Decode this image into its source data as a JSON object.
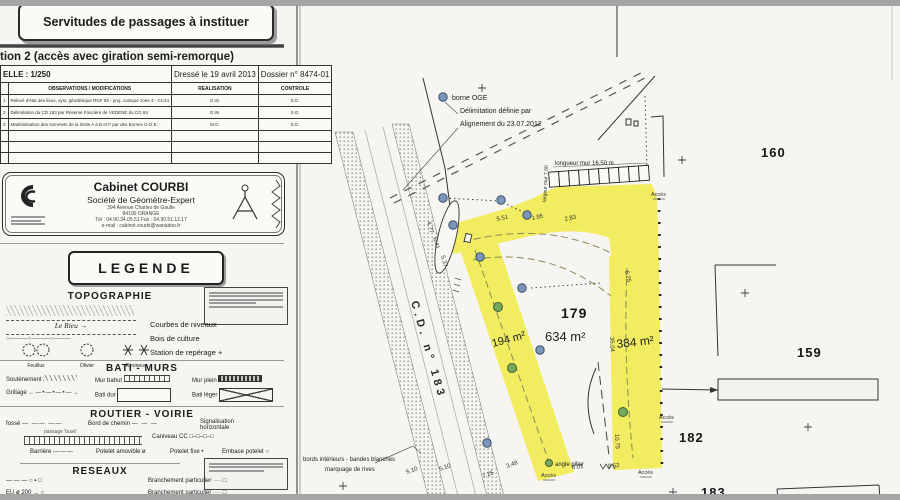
{
  "panel": {
    "box_title": "Servitudes de passages à instituer",
    "subtitle": "tion 2 (accès avec giration semi-remorque)",
    "table": {
      "scale": "ELLE : 1/250",
      "date": "Dressé le 19 avril 2013",
      "dossier": "Dossier n° 8474-01",
      "col_obs": "OBSERVATIONS / MODIFICATIONS",
      "col_real": "REALISATION",
      "col_ctrl": "CONTROLE",
      "rows": [
        {
          "n": "1",
          "obs": "Relevé d'état des lieux, syst. géodésique RGF 93 - proj. conique zone 3 - CC44",
          "real": "G.W.",
          "ctrl": "S.G."
        },
        {
          "n": "2",
          "obs": "Délimitation du CD 183 par Réserve Foncière de VEDENE du CG 84",
          "real": "G.W.",
          "ctrl": "S.G."
        },
        {
          "n": "3",
          "obs": "Matérialisation des sommets de la limite A à B et F par des Bornes O.G.E.",
          "real": "M.G.",
          "ctrl": "S.G."
        }
      ]
    },
    "firm": {
      "name": "Cabinet COURBI",
      "subtitle": "Société de Géomètre-Expert",
      "addr1": "394 Avenue Charles de Gaulle",
      "addr2": "84100 ORANGE",
      "addr3": "Tél : 04.90.34.05.51   Fax : 04.90.51.12.17",
      "addr4": "e-mail : cabinet.courbi@wanadoo.fr"
    },
    "legend": {
      "title": "LEGENDE",
      "topo": {
        "title": "TOPOGRAPHIE",
        "stream": "Le Rieu →",
        "fence": "○———○———○———",
        "c1": "Courbes de niveaux",
        "c2": "Bois de culture",
        "c3": "Station de repérage +",
        "t1": "Feuillus",
        "t2": "Olivier",
        "t3": "Résineux"
      },
      "bati": {
        "title": "BATI - MURS",
        "i1": "Soutènement",
        "i2": "Mur bahut",
        "i3": "Mur plein",
        "i4": "Grillage",
        "i4g": "←—•—•—•—→",
        "i5": "Bati dur",
        "i6": "Bati léger"
      },
      "routier": {
        "title": "ROUTIER - VOIRIE",
        "r1a": "fossé",
        "r1ag": "— —— ——",
        "r1b": "Bord de chemin",
        "r1bg": "— — —",
        "r1c": "Signalisation",
        "r1c2": "horizontale",
        "r2a": "passage 'busé'",
        "r2b": "Caniveau CC",
        "r2bg": "□–□–□–□",
        "r3a": "Barrière",
        "r3ag": "———",
        "r3b": "Potelet amovible ø",
        "r3c": "Potelet fixe •",
        "r3d": "Embase potelet ○"
      },
      "reseaux": {
        "title": "RESEAUX",
        "r1g": "— — —   ○ ▪ □",
        "r1b": "Branchement particulier ···· □",
        "r2g": "EU ø 200 →   ○",
        "r2b": "Branchement particulier ···· □"
      }
    }
  },
  "map": {
    "road_label": "C.D.   n° 183",
    "access_label": "Accès",
    "colors": {
      "highlight": "#f2ec60",
      "borne": "#7b96b8",
      "tree": "#74a85c"
    },
    "wall": {
      "count": 10,
      "x": 254,
      "y": 169,
      "w": 10,
      "h": 15,
      "rot": -4
    },
    "parcels": [
      {
        "t": "179",
        "x": 266,
        "y": 318,
        "s": 14
      },
      {
        "t": "160",
        "x": 466,
        "y": 157,
        "s": 13
      },
      {
        "t": "159",
        "x": 502,
        "y": 357,
        "s": 13
      },
      {
        "t": "182",
        "x": 384,
        "y": 442,
        "s": 13
      },
      {
        "t": "183",
        "x": 406,
        "y": 497,
        "s": 13
      }
    ],
    "areas": [
      {
        "t": "634 m²",
        "x": 250,
        "y": 341,
        "s": 13,
        "r": 0
      },
      {
        "t": "194 m²",
        "x": 198,
        "y": 347,
        "s": 11,
        "r": -15
      },
      {
        "t": "384 m²",
        "x": 322,
        "y": 348,
        "s": 12,
        "r": -6
      }
    ],
    "annotations": [
      {
        "t": "borne OGE",
        "x": 157,
        "y": 100,
        "s": 7
      },
      {
        "t": "Délimitation définie par",
        "x": 165,
        "y": 113,
        "s": 7
      },
      {
        "t": "Alignement du 23.07.2012",
        "x": 165,
        "y": 126,
        "s": 7
      },
      {
        "t": "longueur mur  16.50 m",
        "x": 260,
        "y": 165,
        "s": 6
      },
      {
        "t": "largeur mur 7.60",
        "x": 251,
        "y": 202,
        "s": 5,
        "r": -87
      },
      {
        "t": "bords intérieurs - bandes blanches",
        "x": 8,
        "y": 461,
        "s": 6
      },
      {
        "t": "marquage de rives",
        "x": 30,
        "y": 471,
        "s": 6
      },
      {
        "t": "angle pilier",
        "x": 260,
        "y": 466,
        "s": 6
      }
    ],
    "dimensions": [
      {
        "t": "4.77",
        "x": 132,
        "y": 222,
        "r": 75
      },
      {
        "t": "6.41",
        "x": 138,
        "y": 238,
        "r": 75
      },
      {
        "t": "5.37",
        "x": 146,
        "y": 256,
        "r": 75
      },
      {
        "t": "5.51",
        "x": 202,
        "y": 221,
        "r": -12
      },
      {
        "t": "1.95",
        "x": 237,
        "y": 220,
        "r": -12
      },
      {
        "t": "2.83",
        "x": 270,
        "y": 221,
        "r": -12
      },
      {
        "t": "6.25",
        "x": 330,
        "y": 271,
        "r": 78
      },
      {
        "t": "35.04",
        "x": 315,
        "y": 337,
        "r": 87
      },
      {
        "t": "10.75",
        "x": 320,
        "y": 434,
        "r": 87
      },
      {
        "t": "5.10",
        "x": 112,
        "y": 474,
        "r": -20
      },
      {
        "t": "5.10",
        "x": 145,
        "y": 471,
        "r": -20
      },
      {
        "t": "7.25",
        "x": 188,
        "y": 478,
        "r": -20
      },
      {
        "t": "3.48",
        "x": 212,
        "y": 468,
        "r": -20
      },
      {
        "t": "8.01",
        "x": 277,
        "y": 469,
        "r": -5
      },
      {
        "t": "9.52",
        "x": 313,
        "y": 468,
        "r": -5
      }
    ],
    "bornes": [
      {
        "x": 148,
        "y": 97
      },
      {
        "x": 148,
        "y": 198
      },
      {
        "x": 206,
        "y": 200
      },
      {
        "x": 232,
        "y": 215
      },
      {
        "x": 158,
        "y": 225
      },
      {
        "x": 185,
        "y": 257
      },
      {
        "x": 227,
        "y": 288
      },
      {
        "x": 245,
        "y": 350
      },
      {
        "x": 192,
        "y": 443
      }
    ],
    "trees": [
      {
        "x": 203,
        "y": 307,
        "r": 4.5
      },
      {
        "x": 217,
        "y": 368,
        "r": 4.5
      },
      {
        "x": 328,
        "y": 412,
        "r": 4.5
      },
      {
        "x": 254,
        "y": 463,
        "r": 3.5
      }
    ],
    "crosses": [
      {
        "x": 187,
        "y": 88
      },
      {
        "x": 387,
        "y": 160
      },
      {
        "x": 450,
        "y": 293
      },
      {
        "x": 513,
        "y": 427
      },
      {
        "x": 378,
        "y": 492
      },
      {
        "x": 48,
        "y": 486
      }
    ],
    "access": [
      {
        "x": 356,
        "y": 196
      },
      {
        "x": 364,
        "y": 419
      },
      {
        "x": 343,
        "y": 474
      },
      {
        "x": 246,
        "y": 477
      }
    ]
  }
}
